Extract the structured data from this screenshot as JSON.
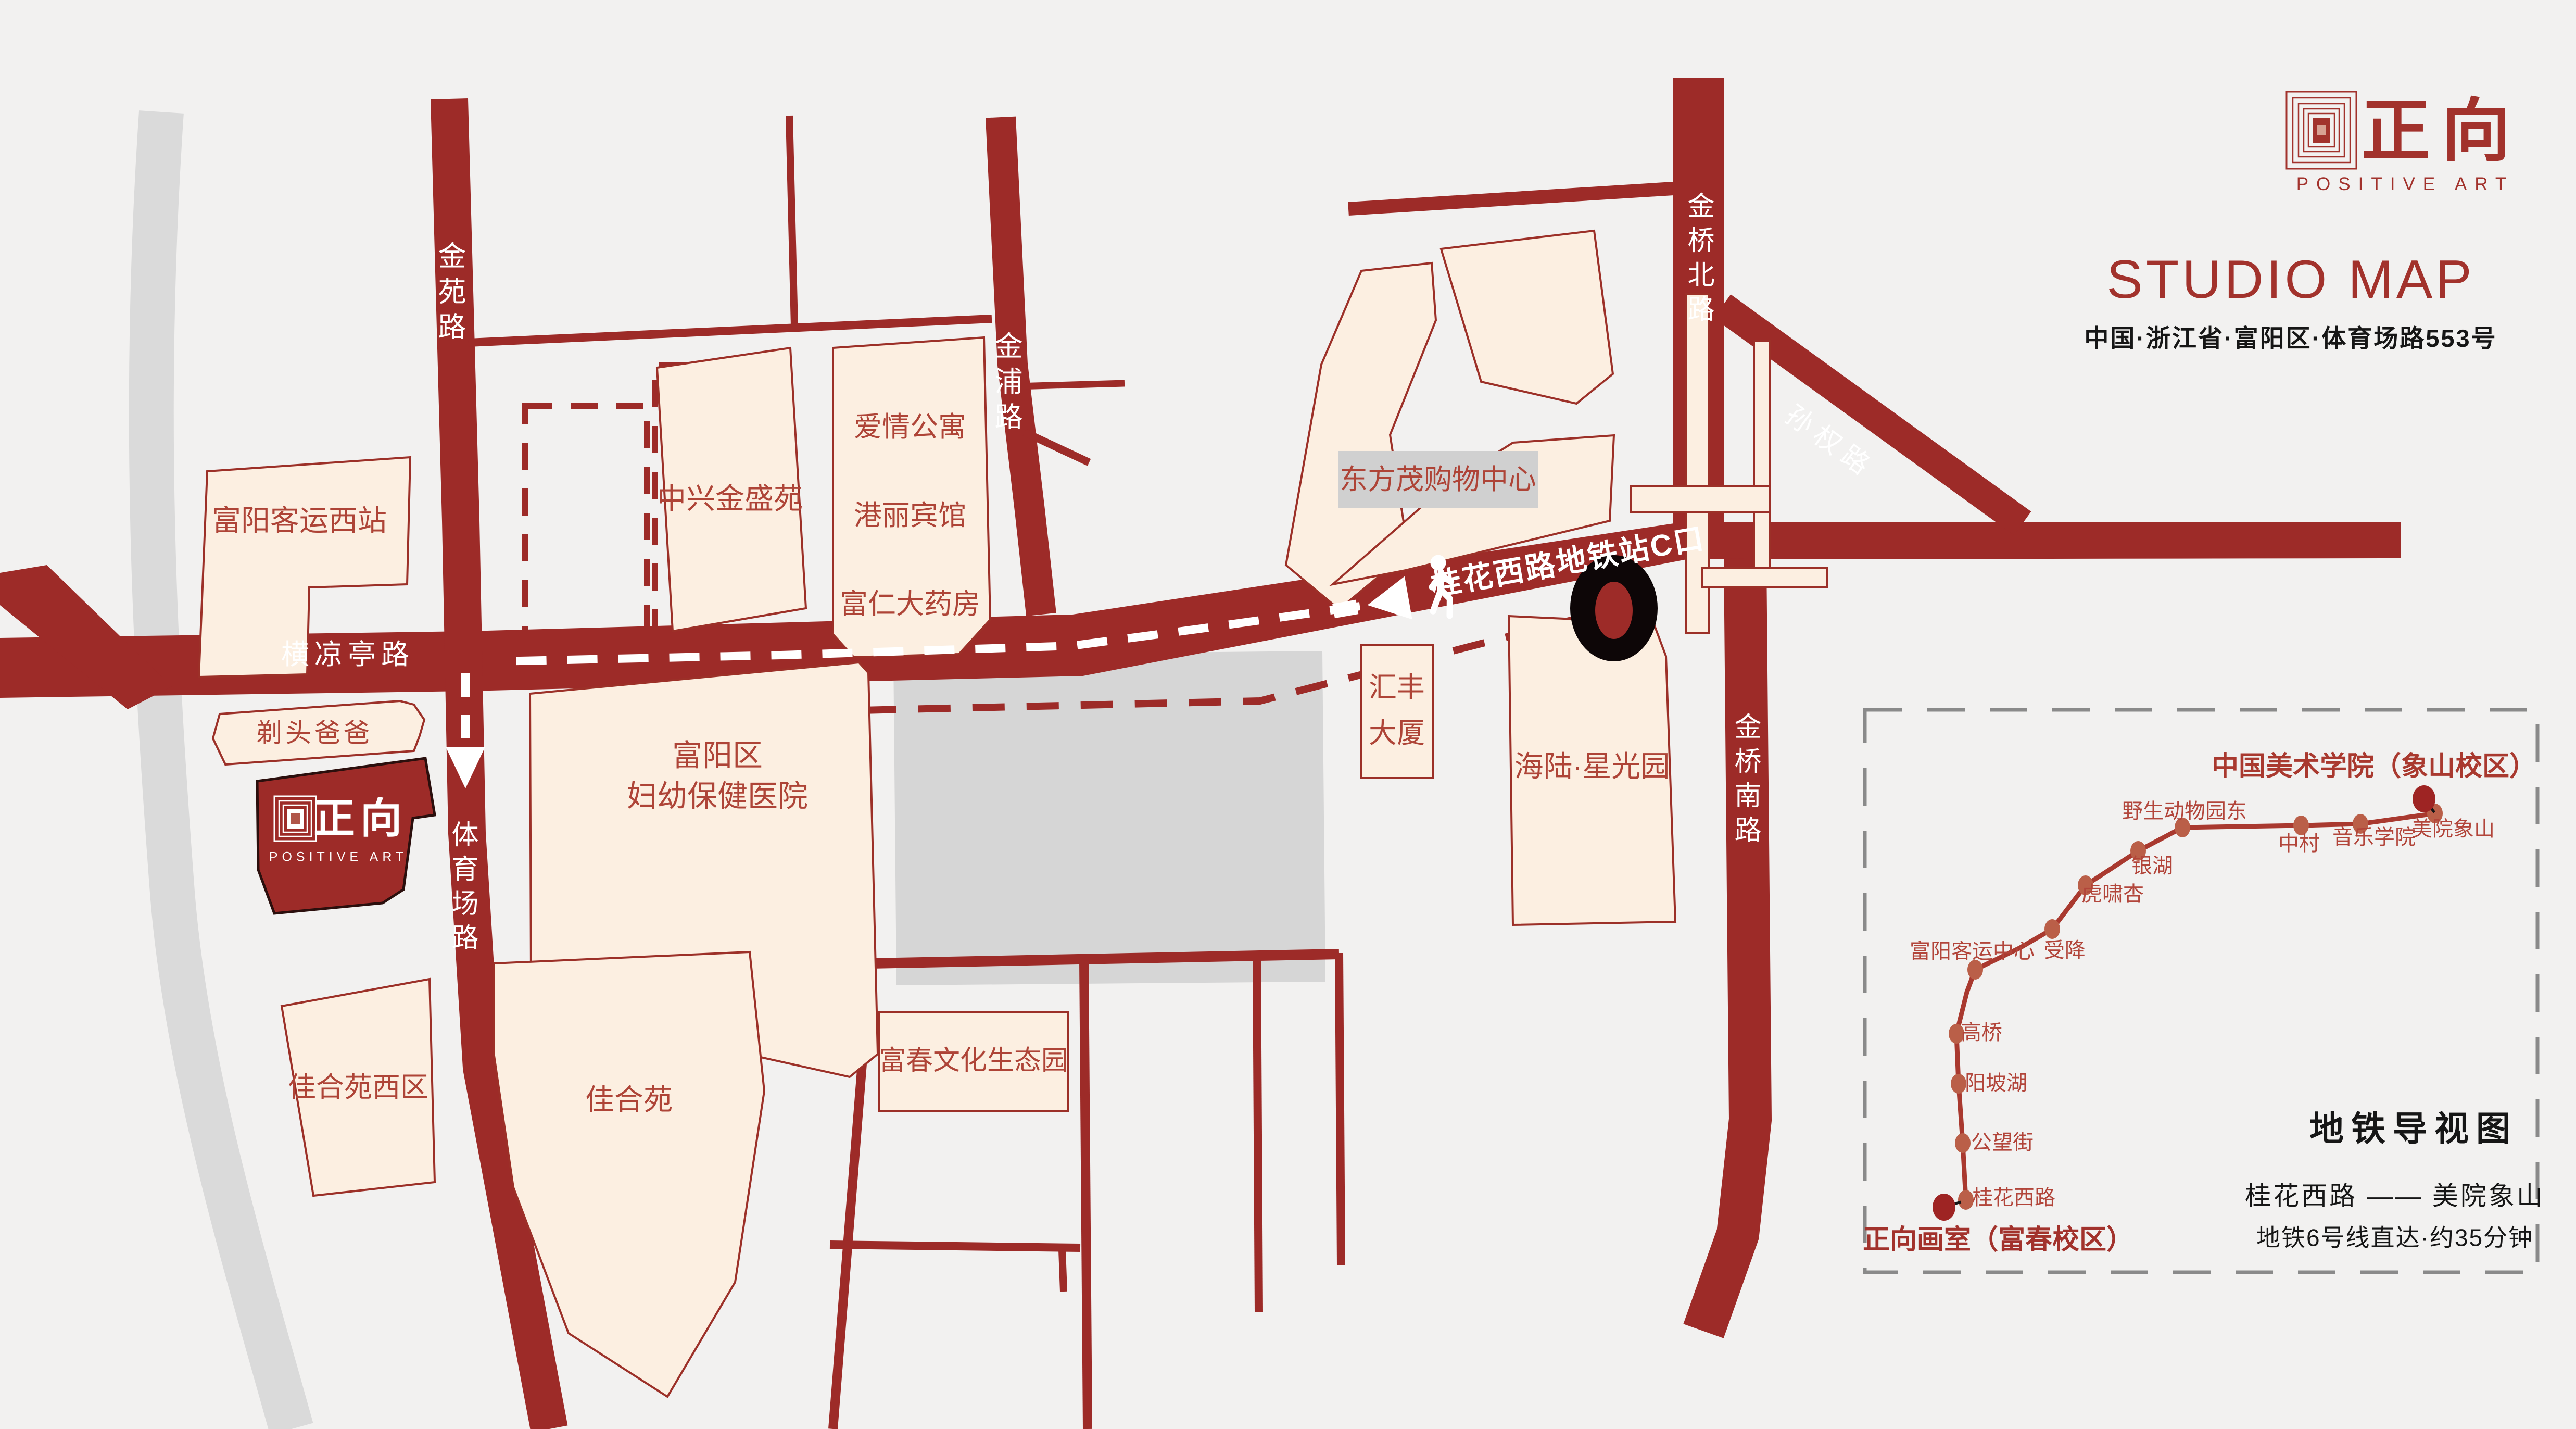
{
  "colors": {
    "background": "#f2f1f0",
    "road_red": "#9d2b28",
    "building_fill": "#fcefe1",
    "building_stroke": "#9c3028",
    "label_red": "#ae4437",
    "brand_red": "#a2322c",
    "metro_line_red": "#a9392f",
    "station_dot": "#ba5f48",
    "terminal_dot": "#9e2423",
    "river_gray": "#dadada",
    "block_gray": "#d6d6d6",
    "panel_border_gray": "#8a8a8a",
    "text_black": "#161616"
  },
  "header": {
    "logo_cn": "正向",
    "logo_en": "POSITIVE ART",
    "title": "STUDIO MAP",
    "address": "中国·浙江省·富阳区·体育场路553号"
  },
  "roads": {
    "jinyuan": "金苑路",
    "jinpu": "金浦路",
    "jinqiao_north": "金桥北路",
    "sunquan": "孙权路",
    "jinqiao_south": "金桥南路",
    "tiyuchang": "体育场路",
    "hengliangting": "横凉亭路"
  },
  "route": {
    "metro_exit_sign": "桂花西路地铁站C口"
  },
  "buildings": {
    "bus_station_west": "富阳客运西站",
    "zhongxing": "中兴金盛苑",
    "love_apartment": "爱情公寓",
    "gangli_hotel": "港丽宾馆",
    "furen_pharmacy": "富仁大药房",
    "dongfangmao": "东方茂购物中心",
    "haircut_dad": "剃头爸爸",
    "hospital_line1": "富阳区",
    "hospital_line2": "妇幼保健医院",
    "hsbc_line1": "汇丰",
    "hsbc_line2": "大厦",
    "hailu": "海陆·星光园",
    "jiaheyuan_west": "佳合苑西区",
    "jiaheyuan": "佳合苑",
    "fuchun_park": "富春文化生态园"
  },
  "studio_marker": {
    "logo_cn": "正向",
    "logo_en": "POSITIVE ART"
  },
  "metro_panel": {
    "title": "地铁导视图",
    "campus_terminal": "中国美术学院（象山校区）",
    "studio_terminal": "正向画室（富春校区）",
    "route_line": "桂花西路 —— 美院象山",
    "note": "地铁6号线直达·约35分钟",
    "stations": [
      {
        "name": "桂花西路"
      },
      {
        "name": "公望街"
      },
      {
        "name": "阳坡湖"
      },
      {
        "name": "高桥"
      },
      {
        "name": "富阳客运中心"
      },
      {
        "name": "受降"
      },
      {
        "name": "虎啸杏"
      },
      {
        "name": "银湖"
      },
      {
        "name": "野生动物园东"
      },
      {
        "name": "中村"
      },
      {
        "name": "音乐学院"
      },
      {
        "name": "美院象山"
      }
    ]
  }
}
